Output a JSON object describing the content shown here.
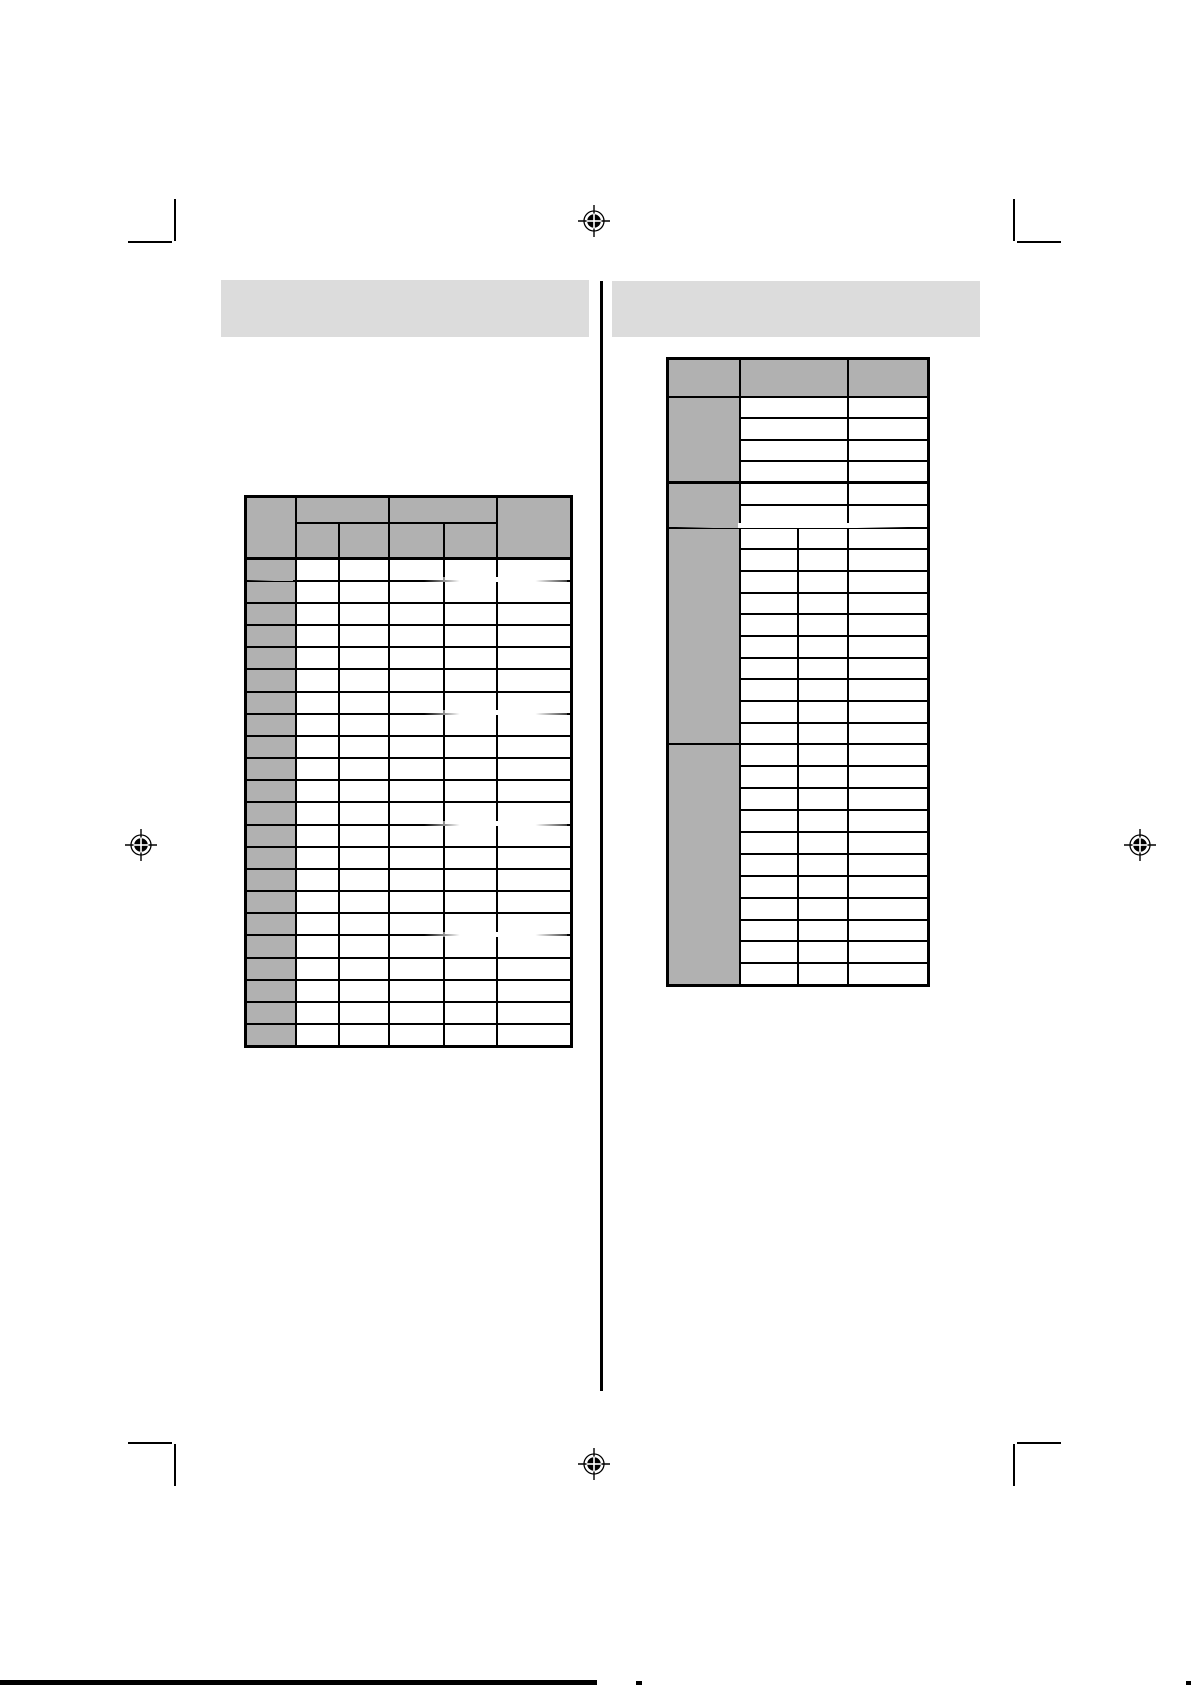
{
  "document": {
    "kind": "scanned manual page with two blank data tables",
    "visible_text": ""
  },
  "colors": {
    "page_background": "#ffffff",
    "title_bar_fill": "#dcdcdc",
    "table_header_fill": "#b1b1b1",
    "line_color": "#000000"
  },
  "left_section": {
    "title_bar_text": "",
    "table": {
      "corner_header": "",
      "group_headers": [
        "",
        ""
      ],
      "sub_headers": [
        "",
        "",
        "",
        ""
      ],
      "right_header": "",
      "row_count": 22,
      "row_label_text": "",
      "cell_text": ""
    }
  },
  "right_section": {
    "title_bar_text": "",
    "table": {
      "column_headers": [
        "",
        "",
        ""
      ],
      "sections": [
        {
          "label": "",
          "rows": 4,
          "middle_split": false
        },
        {
          "label": "",
          "rows": 2,
          "middle_split": false
        },
        {
          "label": "",
          "rows": 10,
          "middle_split": true
        },
        {
          "label": "",
          "rows": 11,
          "middle_split": true
        }
      ]
    }
  },
  "print_marks": {
    "registration_mark_count": 4,
    "crop_mark_count": 4
  }
}
